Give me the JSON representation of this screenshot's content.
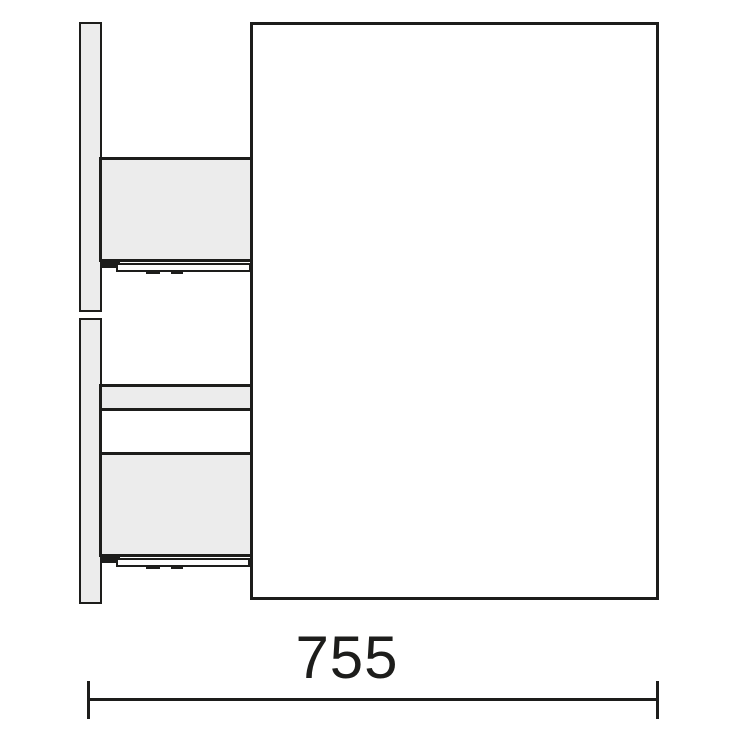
{
  "figure": {
    "type": "furniture-technical-side-section",
    "dimension": {
      "width_label": "755"
    }
  },
  "colors": {
    "outline": "#1d1d1b",
    "panel_fill": "#ececec",
    "rail_fill": "#fdfdfd",
    "background": "#ffffff"
  }
}
